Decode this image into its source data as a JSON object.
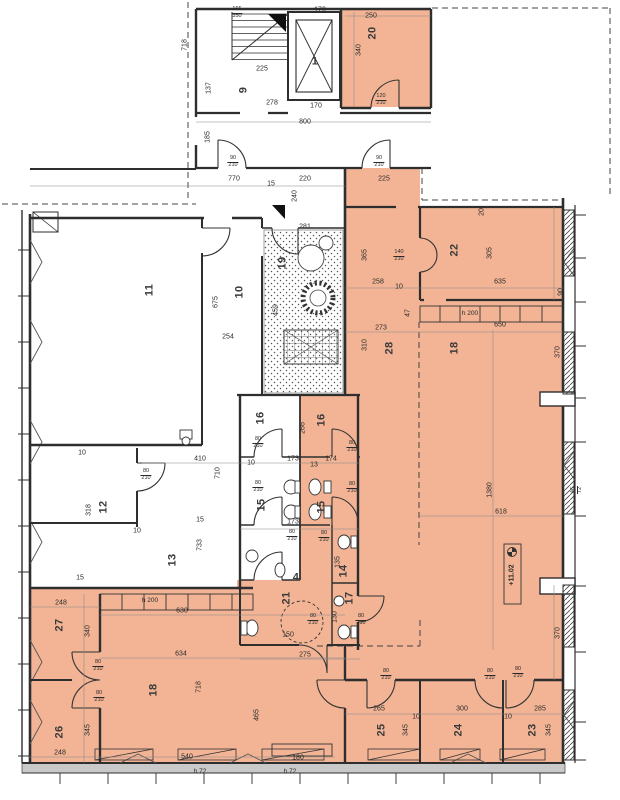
{
  "meta": {
    "type": "architectural-floor-plan",
    "units": "cm"
  },
  "colors": {
    "highlight": "#f2b495",
    "wall": "#2e2e2e",
    "dim_text": "#333333",
    "curtain_band": "#c9c9c9"
  },
  "level_marker": {
    "text": "+11.02"
  },
  "labels": [
    {
      "t": "1",
      "x": 315,
      "y": 62,
      "r": 0,
      "k": "room"
    },
    {
      "t": "9",
      "x": 244,
      "y": 90,
      "r": -90,
      "k": "room"
    },
    {
      "t": "20",
      "x": 373,
      "y": 33,
      "r": -90,
      "k": "room"
    },
    {
      "t": "11",
      "x": 150,
      "y": 290,
      "r": -90,
      "k": "room"
    },
    {
      "t": "10",
      "x": 240,
      "y": 292,
      "r": -90,
      "k": "room"
    },
    {
      "t": "19",
      "x": 283,
      "y": 263,
      "r": -90,
      "k": "room"
    },
    {
      "t": "22",
      "x": 455,
      "y": 250,
      "r": -90,
      "k": "room"
    },
    {
      "t": "28",
      "x": 390,
      "y": 348,
      "r": -90,
      "k": "room"
    },
    {
      "t": "18",
      "x": 455,
      "y": 348,
      "r": -90,
      "k": "room"
    },
    {
      "t": "16",
      "x": 261,
      "y": 418,
      "r": -90,
      "k": "room"
    },
    {
      "t": "16",
      "x": 322,
      "y": 420,
      "r": -90,
      "k": "room"
    },
    {
      "t": "15",
      "x": 262,
      "y": 505,
      "r": -90,
      "k": "room"
    },
    {
      "t": "15",
      "x": 322,
      "y": 507,
      "r": -90,
      "k": "room"
    },
    {
      "t": "4",
      "x": 296,
      "y": 578,
      "r": 0,
      "k": "room"
    },
    {
      "t": "14",
      "x": 344,
      "y": 571,
      "r": -90,
      "k": "room"
    },
    {
      "t": "17",
      "x": 350,
      "y": 598,
      "r": -90,
      "k": "room"
    },
    {
      "t": "21",
      "x": 287,
      "y": 598,
      "r": -90,
      "k": "room"
    },
    {
      "t": "12",
      "x": 104,
      "y": 507,
      "r": -90,
      "k": "room"
    },
    {
      "t": "13",
      "x": 173,
      "y": 560,
      "r": -90,
      "k": "room"
    },
    {
      "t": "27",
      "x": 60,
      "y": 625,
      "r": -90,
      "k": "room"
    },
    {
      "t": "26",
      "x": 60,
      "y": 732,
      "r": -90,
      "k": "room"
    },
    {
      "t": "18",
      "x": 154,
      "y": 690,
      "r": -90,
      "k": "room"
    },
    {
      "t": "25",
      "x": 382,
      "y": 730,
      "r": -90,
      "k": "room"
    },
    {
      "t": "24",
      "x": 459,
      "y": 730,
      "r": -90,
      "k": "room"
    },
    {
      "t": "23",
      "x": 533,
      "y": 730,
      "r": -90,
      "k": "room"
    },
    {
      "t": "170",
      "x": 320,
      "y": 10,
      "r": 0,
      "k": "dim"
    },
    {
      "t": "250",
      "x": 371,
      "y": 16,
      "r": 0,
      "k": "dim"
    },
    {
      "t": "225",
      "x": 262,
      "y": 69,
      "r": 0,
      "k": "dim"
    },
    {
      "t": "278",
      "x": 272,
      "y": 103,
      "r": 0,
      "k": "dim"
    },
    {
      "t": "170",
      "x": 316,
      "y": 106,
      "r": 0,
      "k": "dim"
    },
    {
      "t": "800",
      "x": 305,
      "y": 122,
      "r": 0,
      "k": "dim"
    },
    {
      "t": "770",
      "x": 234,
      "y": 179,
      "r": 0,
      "k": "dim"
    },
    {
      "t": "15",
      "x": 271,
      "y": 184,
      "r": 0,
      "k": "dim"
    },
    {
      "t": "220",
      "x": 305,
      "y": 179,
      "r": 0,
      "k": "dim"
    },
    {
      "t": "225",
      "x": 384,
      "y": 179,
      "r": 0,
      "k": "dim"
    },
    {
      "t": "281",
      "x": 305,
      "y": 227,
      "r": 0,
      "k": "dim"
    },
    {
      "t": "254",
      "x": 228,
      "y": 337,
      "r": 0,
      "k": "dim"
    },
    {
      "t": "258",
      "x": 378,
      "y": 282,
      "r": 0,
      "k": "dim"
    },
    {
      "t": "10",
      "x": 399,
      "y": 287,
      "r": 0,
      "k": "dim"
    },
    {
      "t": "635",
      "x": 500,
      "y": 282,
      "r": 0,
      "k": "dim"
    },
    {
      "t": "273",
      "x": 381,
      "y": 328,
      "r": 0,
      "k": "dim"
    },
    {
      "t": "650",
      "x": 500,
      "y": 325,
      "r": 0,
      "k": "dim"
    },
    {
      "t": "618",
      "x": 501,
      "y": 512,
      "r": 0,
      "k": "dim"
    },
    {
      "t": "10",
      "x": 251,
      "y": 463,
      "r": 0,
      "k": "dim"
    },
    {
      "t": "173",
      "x": 293,
      "y": 459,
      "r": 0,
      "k": "dim"
    },
    {
      "t": "174",
      "x": 331,
      "y": 459,
      "r": 0,
      "k": "dim"
    },
    {
      "t": "13",
      "x": 314,
      "y": 465,
      "r": 0,
      "k": "dim"
    },
    {
      "t": "173",
      "x": 293,
      "y": 522,
      "r": 0,
      "k": "dim"
    },
    {
      "t": "10",
      "x": 82,
      "y": 453,
      "r": 0,
      "k": "dim"
    },
    {
      "t": "410",
      "x": 200,
      "y": 459,
      "r": 0,
      "k": "dim"
    },
    {
      "t": "15",
      "x": 200,
      "y": 520,
      "r": 0,
      "k": "dim"
    },
    {
      "t": "10",
      "x": 137,
      "y": 531,
      "r": 0,
      "k": "dim"
    },
    {
      "t": "15",
      "x": 80,
      "y": 578,
      "r": 0,
      "k": "dim"
    },
    {
      "t": "248",
      "x": 61,
      "y": 603,
      "r": 0,
      "k": "dim"
    },
    {
      "t": "630",
      "x": 182,
      "y": 611,
      "r": 0,
      "k": "dim"
    },
    {
      "t": "634",
      "x": 181,
      "y": 654,
      "r": 0,
      "k": "dim"
    },
    {
      "t": "275",
      "x": 305,
      "y": 655,
      "r": 0,
      "k": "dim"
    },
    {
      "t": "150",
      "x": 288,
      "y": 635,
      "r": 0,
      "k": "dim"
    },
    {
      "t": "248",
      "x": 60,
      "y": 753,
      "r": 0,
      "k": "dim"
    },
    {
      "t": "540",
      "x": 187,
      "y": 757,
      "r": 0,
      "k": "dim"
    },
    {
      "t": "180",
      "x": 298,
      "y": 758,
      "r": 0,
      "k": "dim"
    },
    {
      "t": "265",
      "x": 379,
      "y": 709,
      "r": 0,
      "k": "dim"
    },
    {
      "t": "300",
      "x": 462,
      "y": 709,
      "r": 0,
      "k": "dim"
    },
    {
      "t": "285",
      "x": 540,
      "y": 709,
      "r": 0,
      "k": "dim"
    },
    {
      "t": "10",
      "x": 416,
      "y": 717,
      "r": 0,
      "k": "dim"
    },
    {
      "t": "10",
      "x": 508,
      "y": 717,
      "r": 0,
      "k": "dim"
    },
    {
      "t": "340",
      "x": 359,
      "y": 50,
      "r": -90,
      "k": "dim"
    },
    {
      "t": "718",
      "x": 185,
      "y": 45,
      "r": -90,
      "k": "dim"
    },
    {
      "t": "137",
      "x": 209,
      "y": 88,
      "r": -90,
      "k": "dim"
    },
    {
      "t": "185",
      "x": 208,
      "y": 137,
      "r": -90,
      "k": "dim"
    },
    {
      "t": "240",
      "x": 295,
      "y": 196,
      "r": -90,
      "k": "dim"
    },
    {
      "t": "365",
      "x": 365,
      "y": 255,
      "r": -90,
      "k": "dim"
    },
    {
      "t": "305",
      "x": 490,
      "y": 253,
      "r": -90,
      "k": "dim"
    },
    {
      "t": "20",
      "x": 482,
      "y": 212,
      "r": -90,
      "k": "dim"
    },
    {
      "t": "675",
      "x": 216,
      "y": 302,
      "r": -90,
      "k": "dim"
    },
    {
      "t": "459",
      "x": 276,
      "y": 310,
      "r": -90,
      "k": "dim"
    },
    {
      "t": "310",
      "x": 365,
      "y": 345,
      "r": -90,
      "k": "dim"
    },
    {
      "t": "1380",
      "x": 490,
      "y": 490,
      "r": -90,
      "k": "dim"
    },
    {
      "t": "370",
      "x": 558,
      "y": 352,
      "r": -90,
      "k": "dim"
    },
    {
      "t": "90",
      "x": 561,
      "y": 292,
      "r": -90,
      "k": "dim"
    },
    {
      "t": "370",
      "x": 558,
      "y": 633,
      "r": -90,
      "k": "dim"
    },
    {
      "t": "266",
      "x": 303,
      "y": 428,
      "r": -90,
      "k": "dim"
    },
    {
      "t": "318",
      "x": 89,
      "y": 510,
      "r": -90,
      "k": "dim"
    },
    {
      "t": "710",
      "x": 218,
      "y": 473,
      "r": -90,
      "k": "dim"
    },
    {
      "t": "733",
      "x": 200,
      "y": 545,
      "r": -90,
      "k": "dim"
    },
    {
      "t": "340",
      "x": 88,
      "y": 631,
      "r": -90,
      "k": "dim"
    },
    {
      "t": "345",
      "x": 88,
      "y": 730,
      "r": -90,
      "k": "dim"
    },
    {
      "t": "718",
      "x": 199,
      "y": 687,
      "r": -90,
      "k": "dim"
    },
    {
      "t": "465",
      "x": 257,
      "y": 715,
      "r": -90,
      "k": "dim"
    },
    {
      "t": "135",
      "x": 338,
      "y": 562,
      "r": -90,
      "k": "dim"
    },
    {
      "t": "130",
      "x": 335,
      "y": 617,
      "r": -90,
      "k": "dim"
    },
    {
      "t": "47",
      "x": 408,
      "y": 313,
      "r": -90,
      "k": "dim"
    },
    {
      "t": "345",
      "x": 406,
      "y": 730,
      "r": -90,
      "k": "dim"
    },
    {
      "t": "345",
      "x": 549,
      "y": 730,
      "r": -90,
      "k": "dim"
    },
    {
      "t": "165/350",
      "x": 237,
      "y": 13,
      "r": 0,
      "k": "frac"
    },
    {
      "t": "120/210",
      "x": 381,
      "y": 100,
      "r": 0,
      "k": "frac"
    },
    {
      "t": "90/210",
      "x": 233,
      "y": 162,
      "r": 0,
      "k": "frac"
    },
    {
      "t": "90/210",
      "x": 379,
      "y": 162,
      "r": 0,
      "k": "frac"
    },
    {
      "t": "140/210",
      "x": 399,
      "y": 256,
      "r": 0,
      "k": "frac"
    },
    {
      "t": "80/210",
      "x": 258,
      "y": 443,
      "r": 0,
      "k": "frac"
    },
    {
      "t": "80/210",
      "x": 352,
      "y": 447,
      "r": 0,
      "k": "frac"
    },
    {
      "t": "80/210",
      "x": 258,
      "y": 487,
      "r": 0,
      "k": "frac"
    },
    {
      "t": "80/210",
      "x": 352,
      "y": 488,
      "r": 0,
      "k": "frac"
    },
    {
      "t": "80/210",
      "x": 146,
      "y": 475,
      "r": 0,
      "k": "frac"
    },
    {
      "t": "80/210",
      "x": 292,
      "y": 536,
      "r": 0,
      "k": "frac"
    },
    {
      "t": "80/210",
      "x": 324,
      "y": 537,
      "r": 0,
      "k": "frac"
    },
    {
      "t": "80/210",
      "x": 313,
      "y": 620,
      "r": 0,
      "k": "frac"
    },
    {
      "t": "80/210",
      "x": 361,
      "y": 620,
      "r": 0,
      "k": "frac"
    },
    {
      "t": "80/210",
      "x": 98,
      "y": 666,
      "r": 0,
      "k": "frac"
    },
    {
      "t": "80/210",
      "x": 99,
      "y": 697,
      "r": 0,
      "k": "frac"
    },
    {
      "t": "80/210",
      "x": 386,
      "y": 675,
      "r": 0,
      "k": "frac"
    },
    {
      "t": "80/210",
      "x": 490,
      "y": 675,
      "r": 0,
      "k": "frac"
    },
    {
      "t": "80/210",
      "x": 518,
      "y": 673,
      "r": 0,
      "k": "frac"
    },
    {
      "t": "46/72",
      "x": 577,
      "y": 490,
      "r": -90,
      "k": "frac"
    },
    {
      "t": "h 200",
      "x": 470,
      "y": 314,
      "r": 0,
      "k": "note"
    },
    {
      "t": "h 200",
      "x": 150,
      "y": 601,
      "r": 0,
      "k": "note"
    },
    {
      "t": "h 72",
      "x": 200,
      "y": 772,
      "r": 0,
      "k": "note"
    },
    {
      "t": "h 72",
      "x": 290,
      "y": 772,
      "r": 0,
      "k": "note"
    },
    {
      "t": "+11.02",
      "x": 512,
      "y": 575,
      "r": -90,
      "k": "level"
    }
  ]
}
